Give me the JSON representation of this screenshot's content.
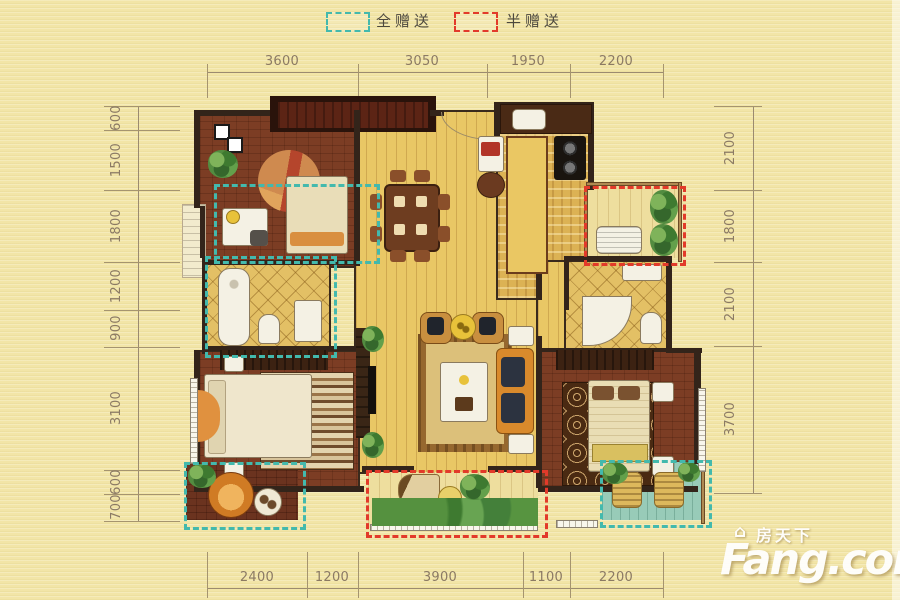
{
  "legend": {
    "items": [
      {
        "label": "全赠送",
        "color": "#43b9ad"
      },
      {
        "label": "半赠送",
        "color": "#e23a2a"
      }
    ]
  },
  "dimensions": {
    "top": [
      "3600",
      "3050",
      "1950",
      "2200"
    ],
    "bottom": [
      "2400",
      "1200",
      "3900",
      "1100",
      "2200"
    ],
    "left": [
      "600",
      "1500",
      "1800",
      "1200",
      "900",
      "3100",
      "600",
      "700"
    ],
    "right": [
      "2100",
      "1800",
      "2100",
      "3700"
    ]
  },
  "watermark": {
    "brand_cn": "房天下",
    "brand_en": "Fang.com",
    "house_icon_glyph": "⌂"
  },
  "colors": {
    "background": "#f2e5a7",
    "full_gift_dash": "#43b9ad",
    "half_gift_dash": "#e23a2a",
    "dimension_text": "#8b7a64",
    "wall": "#33241a"
  }
}
